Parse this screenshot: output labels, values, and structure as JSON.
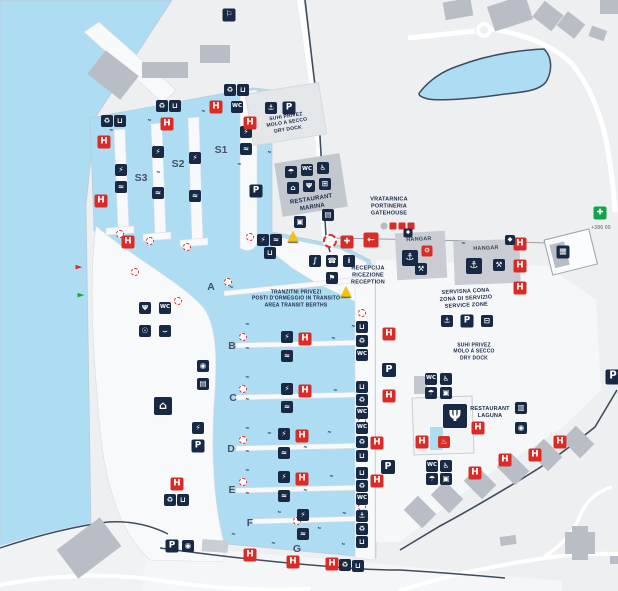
{
  "map_name": "marina-site-map",
  "colors": {
    "water": "#aedcf2",
    "land": "#edeff1",
    "pier": "#f7f9fb",
    "building": "#b9bec6",
    "navy": "#182945",
    "red": "#da2c26",
    "green": "#13a34a",
    "yellow": "#f3c403",
    "fence": "#3d4c5e",
    "text": "#1c2b4a"
  },
  "berths": [
    {
      "label": "S1",
      "x": 221,
      "y": 150
    },
    {
      "label": "S2",
      "x": 178,
      "y": 164
    },
    {
      "label": "S3",
      "x": 141,
      "y": 178
    },
    {
      "label": "A",
      "x": 211,
      "y": 287
    },
    {
      "label": "B",
      "x": 232,
      "y": 346
    },
    {
      "label": "C",
      "x": 233,
      "y": 398
    },
    {
      "label": "D",
      "x": 231,
      "y": 449
    },
    {
      "label": "E",
      "x": 232,
      "y": 490
    },
    {
      "label": "F",
      "x": 250,
      "y": 523
    },
    {
      "label": "G",
      "x": 297,
      "y": 549
    }
  ],
  "texts": [
    {
      "id": "drydock-top",
      "lines": [
        "SUHI PRIVEZ",
        "MOLO A SECCO",
        "DRY DOCK"
      ],
      "x": 287,
      "y": 123,
      "size": 5,
      "rot": -9
    },
    {
      "id": "restaurant-marina",
      "lines": [
        "RESTAURANT",
        "MARINA"
      ],
      "x": 312,
      "y": 204,
      "size": 6,
      "rot": -9
    },
    {
      "id": "gatehouse",
      "lines": [
        "VRATARNICA",
        "PORTINERIA",
        "GATEHOUSE"
      ],
      "x": 389,
      "y": 207,
      "size": 5.5,
      "rot": 0
    },
    {
      "id": "hangar-1",
      "lines": [
        "HANGAR"
      ],
      "x": 419,
      "y": 240,
      "size": 5.5,
      "rot": -3,
      "color": "#3e4857"
    },
    {
      "id": "hangar-2",
      "lines": [
        "HANGAR"
      ],
      "x": 486,
      "y": 249,
      "size": 5.5,
      "rot": -2,
      "color": "#3e4857"
    },
    {
      "id": "reception",
      "lines": [
        "RECEPCIJA",
        "RICEZIONE",
        "RECEPTION"
      ],
      "x": 368,
      "y": 276,
      "size": 5.5,
      "rot": 0
    },
    {
      "id": "transit-berths",
      "lines": [
        "TRANZITNI PRIVEZI",
        "POSTI D'ORMEGGIO IN TRANSITO",
        "AREA TRANSIT BERTHS"
      ],
      "x": 296,
      "y": 299,
      "size": 5,
      "rot": 0
    },
    {
      "id": "service-zone",
      "lines": [
        "SERVISNA CONA",
        "ZONA DI SERVIZIO",
        "SERVICE ZONE"
      ],
      "x": 466,
      "y": 299,
      "size": 5.5,
      "rot": -3
    },
    {
      "id": "drydock-right",
      "lines": [
        "SUHI PRIVEZ",
        "MOLO A SECCO",
        "DRY DOCK"
      ],
      "x": 474,
      "y": 352,
      "size": 5,
      "rot": 0
    },
    {
      "id": "restaurant-laguna",
      "lines": [
        "RESTAURANT",
        "LAGUNA"
      ],
      "x": 490,
      "y": 413,
      "size": 5.5,
      "rot": 0
    },
    {
      "id": "phone-number",
      "lines": [
        "+386 05"
      ],
      "x": 601,
      "y": 228,
      "size": 5,
      "rot": 0,
      "color": "#7f8992"
    }
  ],
  "marker_types": {
    "h": {
      "glyph": "H",
      "name": "hydrant-icon",
      "style": "red",
      "size": 13
    },
    "p": {
      "glyph": "P",
      "name": "parking-icon",
      "style": "navy",
      "size": 13
    },
    "plug": {
      "glyph": "⚡",
      "name": "electricity-icon",
      "style": "navy",
      "size": 12
    },
    "water": {
      "glyph": "≈",
      "name": "water-supply-icon",
      "style": "navy",
      "size": 12
    },
    "wc": {
      "glyph": "WC",
      "name": "wc-icon",
      "style": "navy",
      "size": 12
    },
    "acc": {
      "glyph": "♿",
      "name": "accessible-icon",
      "style": "navy",
      "size": 12
    },
    "shower": {
      "glyph": "☂",
      "name": "shower-icon",
      "style": "navy",
      "size": 12
    },
    "rest": {
      "glyph": "Ψ",
      "name": "restaurant-icon",
      "style": "navy",
      "size": 12
    },
    "bed": {
      "glyph": "⌂",
      "name": "hotel-icon",
      "style": "navy",
      "size": 12
    },
    "cart": {
      "glyph": "⊞",
      "name": "shop-cart-icon",
      "style": "navy",
      "size": 12
    },
    "rec": {
      "glyph": "♻",
      "name": "recycle-icon",
      "style": "navy",
      "size": 12
    },
    "trash": {
      "glyph": "⊔",
      "name": "trash-icon",
      "style": "navy",
      "size": 12
    },
    "phone": {
      "glyph": "☎",
      "name": "phone-icon",
      "style": "navy",
      "size": 12
    },
    "info": {
      "glyph": "i",
      "name": "info-icon",
      "style": "navy",
      "size": 12
    },
    "aid": {
      "glyph": "✚",
      "name": "first-aid-icon",
      "style": "red",
      "size": 13
    },
    "gcross": {
      "glyph": "✚",
      "name": "pharmacy-cross-icon",
      "style": "green",
      "size": 13
    },
    "ring": {
      "glyph": "",
      "name": "life-ring-icon",
      "style": "ring",
      "size": 14
    },
    "ringsm": {
      "glyph": "",
      "name": "life-ring-marker",
      "style": "ringsm",
      "size": 8
    },
    "fuel": {
      "glyph": "∫",
      "name": "fuel-station-icon",
      "style": "navy",
      "size": 12
    },
    "anchor": {
      "glyph": "⚓",
      "name": "boat-lift-icon",
      "style": "navy",
      "size": 12
    },
    "tools": {
      "glyph": "⚒",
      "name": "repair-icon",
      "style": "navy",
      "size": 12
    },
    "redtool": {
      "glyph": "⚙",
      "name": "travel-lift-icon",
      "style": "red",
      "size": 11
    },
    "flag": {
      "glyph": "⚐",
      "name": "windsock-icon",
      "style": "navy",
      "size": 13
    },
    "arrow": {
      "glyph": "←",
      "name": "entrance-arrow-icon",
      "style": "red",
      "size": 15
    },
    "navred": {
      "glyph": "►",
      "name": "port-light-red-icon",
      "style": "navr",
      "size": 9
    },
    "navgreen": {
      "glyph": "►",
      "name": "port-light-green-icon",
      "style": "navg",
      "size": 9
    },
    "warn": {
      "glyph": "▲",
      "name": "warning-icon",
      "style": "warn",
      "size": 14
    },
    "hash": {
      "glyph": "″",
      "name": "mooring-mark",
      "style": "hash",
      "size": 9
    },
    "cam": {
      "glyph": "◉",
      "name": "cctv-icon",
      "style": "navy",
      "size": 12
    },
    "vend": {
      "glyph": "▤",
      "name": "vending-icon",
      "style": "navy",
      "size": 12
    },
    "laundry": {
      "glyph": "▣",
      "name": "laundry-icon",
      "style": "navy",
      "size": 12
    },
    "shop": {
      "glyph": "▦",
      "name": "kiosk-icon",
      "style": "navy",
      "size": 13
    },
    "lockr": {
      "glyph": "▥",
      "name": "locker-icon",
      "style": "navy",
      "size": 12
    },
    "sign": {
      "glyph": "◆",
      "name": "sign-icon",
      "style": "navy",
      "size": 9
    },
    "grayd": {
      "glyph": "",
      "name": "gate-dot",
      "style": "gray",
      "size": 7
    },
    "redsq": {
      "glyph": "",
      "name": "gate-light",
      "style": "redsq",
      "size": 7
    },
    "spa": {
      "glyph": "♨",
      "name": "wellness-icon",
      "style": "red",
      "size": 12
    },
    "customs": {
      "glyph": "⚑",
      "name": "harbour-office-icon",
      "style": "navy",
      "size": 12
    },
    "trailer": {
      "glyph": "⊟",
      "name": "boat-trailer-icon",
      "style": "navy",
      "size": 12
    },
    "ball": {
      "glyph": "☉",
      "name": "sports-icon",
      "style": "navy",
      "size": 12
    },
    "hammock": {
      "glyph": "⌣",
      "name": "beach-icon",
      "style": "navy",
      "size": 12
    }
  },
  "markers": [
    [
      "navred",
      79,
      268
    ],
    [
      "navgreen",
      81,
      296
    ],
    [
      "ringsm",
      120,
      234
    ],
    [
      "ringsm",
      135,
      272
    ],
    [
      "ringsm",
      178,
      301
    ],
    [
      "ringsm",
      150,
      241
    ],
    [
      "ringsm",
      187,
      247
    ],
    [
      "ringsm",
      250,
      237
    ],
    [
      "ringsm",
      228,
      282
    ],
    [
      "ringsm",
      243,
      337
    ],
    [
      "ringsm",
      243,
      389
    ],
    [
      "ringsm",
      243,
      440
    ],
    [
      "ringsm",
      243,
      482
    ],
    [
      "ringsm",
      297,
      521
    ],
    [
      "ringsm",
      362,
      313
    ],
    [
      "ringsm",
      362,
      421
    ],
    [
      "ringsm",
      362,
      507
    ],
    [
      "hash",
      230,
      291
    ],
    [
      "hash",
      246,
      328
    ],
    [
      "hash",
      246,
      352
    ],
    [
      "hash",
      332,
      342
    ],
    [
      "hash",
      352,
      330
    ],
    [
      "hash",
      246,
      381
    ],
    [
      "hash",
      246,
      403
    ],
    [
      "hash",
      334,
      394
    ],
    [
      "hash",
      246,
      432
    ],
    [
      "hash",
      246,
      455
    ],
    [
      "hash",
      268,
      437
    ],
    [
      "hash",
      328,
      436
    ],
    [
      "hash",
      304,
      451
    ],
    [
      "hash",
      246,
      474
    ],
    [
      "hash",
      246,
      497
    ],
    [
      "hash",
      330,
      480
    ],
    [
      "hash",
      304,
      494
    ],
    [
      "hash",
      278,
      516
    ],
    [
      "hash",
      343,
      517
    ],
    [
      "hash",
      318,
      532
    ],
    [
      "hash",
      232,
      538
    ],
    [
      "hash",
      272,
      547
    ],
    [
      "hash",
      342,
      548
    ],
    [
      "hash",
      110,
      134
    ],
    [
      "hash",
      148,
      124
    ],
    [
      "hash",
      202,
      115
    ],
    [
      "hash",
      157,
      176
    ],
    [
      "hash",
      189,
      166
    ],
    [
      "hash",
      238,
      168
    ],
    [
      "hash",
      268,
      156
    ],
    [
      "hash",
      462,
      247
    ],
    [
      "rec",
      107,
      121
    ],
    [
      "trash",
      120,
      121
    ],
    [
      "rec",
      162,
      106
    ],
    [
      "trash",
      175,
      106
    ],
    [
      "rec",
      230,
      90
    ],
    [
      "trash",
      243,
      90
    ],
    [
      "wc",
      237,
      107
    ],
    [
      "plug",
      121,
      170
    ],
    [
      "water",
      121,
      187
    ],
    [
      "plug",
      158,
      152
    ],
    [
      "water",
      158,
      193
    ],
    [
      "plug",
      195,
      158
    ],
    [
      "water",
      195,
      196
    ],
    [
      "plug",
      246,
      132
    ],
    [
      "water",
      246,
      149
    ],
    [
      "plug",
      263,
      240
    ],
    [
      "water",
      276,
      240
    ],
    [
      "trash",
      270,
      253
    ],
    [
      "h",
      104,
      142
    ],
    [
      "h",
      167,
      124
    ],
    [
      "h",
      216,
      107
    ],
    [
      "h",
      250,
      123
    ],
    [
      "h",
      101,
      201
    ],
    [
      "h",
      128,
      242
    ],
    [
      "rest",
      145,
      308
    ],
    [
      "wc",
      165,
      308
    ],
    [
      "ball",
      145,
      331
    ],
    [
      "hammock",
      165,
      331
    ],
    [
      "cam",
      203,
      366
    ],
    [
      "vend",
      203,
      384
    ],
    [
      "bed",
      163,
      406,
      18
    ],
    [
      "plug",
      198,
      428
    ],
    [
      "p",
      198,
      446
    ],
    [
      "h",
      177,
      484
    ],
    [
      "rec",
      170,
      500
    ],
    [
      "trash",
      183,
      500
    ],
    [
      "p",
      172,
      546
    ],
    [
      "cam",
      188,
      546
    ],
    [
      "shower",
      291,
      172
    ],
    [
      "wc",
      307,
      170
    ],
    [
      "acc",
      323,
      168
    ],
    [
      "bed",
      293,
      188
    ],
    [
      "rest",
      309,
      186
    ],
    [
      "cart",
      325,
      184
    ],
    [
      "laundry",
      300,
      222
    ],
    [
      "vend",
      328,
      215
    ],
    [
      "p",
      256,
      191
    ],
    [
      "anchor",
      271,
      108
    ],
    [
      "p",
      289,
      108
    ],
    [
      "plug",
      287,
      337
    ],
    [
      "h",
      305,
      339
    ],
    [
      "water",
      287,
      356
    ],
    [
      "plug",
      287,
      389
    ],
    [
      "h",
      305,
      391
    ],
    [
      "water",
      287,
      407
    ],
    [
      "plug",
      284,
      434
    ],
    [
      "h",
      302,
      436
    ],
    [
      "water",
      284,
      453
    ],
    [
      "plug",
      284,
      477
    ],
    [
      "h",
      302,
      479
    ],
    [
      "water",
      284,
      496
    ],
    [
      "plug",
      303,
      515
    ],
    [
      "water",
      303,
      534
    ],
    [
      "trash",
      362,
      327
    ],
    [
      "rec",
      362,
      341
    ],
    [
      "wc",
      362,
      355
    ],
    [
      "h",
      389,
      334
    ],
    [
      "p",
      389,
      370,
      14
    ],
    [
      "trash",
      362,
      387
    ],
    [
      "rec",
      362,
      400
    ],
    [
      "wc",
      362,
      413
    ],
    [
      "h",
      389,
      396
    ],
    [
      "wc",
      362,
      428
    ],
    [
      "rec",
      362,
      442
    ],
    [
      "trash",
      362,
      456
    ],
    [
      "h",
      377,
      443
    ],
    [
      "p",
      388,
      467,
      14
    ],
    [
      "trash",
      362,
      473
    ],
    [
      "rec",
      362,
      486
    ],
    [
      "wc",
      362,
      499
    ],
    [
      "h",
      377,
      481
    ],
    [
      "anchor",
      362,
      516
    ],
    [
      "rec",
      362,
      529
    ],
    [
      "trash",
      362,
      542
    ],
    [
      "h",
      250,
      555
    ],
    [
      "h",
      293,
      562
    ],
    [
      "h",
      332,
      564
    ],
    [
      "rec",
      345,
      565
    ],
    [
      "trash",
      358,
      566
    ],
    [
      "h",
      520,
      244
    ],
    [
      "h",
      520,
      266
    ],
    [
      "h",
      520,
      288
    ],
    [
      "p",
      613,
      377,
      15
    ],
    [
      "ring",
      330,
      241
    ],
    [
      "aid",
      347,
      242
    ],
    [
      "fuel",
      315,
      261
    ],
    [
      "phone",
      332,
      261
    ],
    [
      "info",
      349,
      261
    ],
    [
      "customs",
      332,
      278
    ],
    [
      "grayd",
      384,
      226
    ],
    [
      "redsq",
      393,
      226
    ],
    [
      "redsq",
      402,
      226
    ],
    [
      "redsq",
      411,
      226
    ],
    [
      "arrow",
      371,
      240
    ],
    [
      "sign",
      408,
      233
    ],
    [
      "sign",
      510,
      240,
      10
    ],
    [
      "anchor",
      410,
      258,
      16
    ],
    [
      "redtool",
      427,
      251
    ],
    [
      "tools",
      421,
      269
    ],
    [
      "anchor",
      474,
      266,
      16
    ],
    [
      "tools",
      499,
      265
    ],
    [
      "anchor",
      447,
      321
    ],
    [
      "p",
      467,
      321
    ],
    [
      "trailer",
      487,
      321
    ],
    [
      "wc",
      431,
      379
    ],
    [
      "acc",
      446,
      379
    ],
    [
      "shower",
      431,
      393
    ],
    [
      "laundry",
      446,
      393
    ],
    [
      "wc",
      432,
      466
    ],
    [
      "acc",
      446,
      466
    ],
    [
      "shower",
      432,
      479
    ],
    [
      "laundry",
      446,
      479
    ],
    [
      "rest",
      455,
      416,
      24
    ],
    [
      "h",
      478,
      428
    ],
    [
      "h",
      422,
      442
    ],
    [
      "spa",
      444,
      442
    ],
    [
      "lockr",
      521,
      408
    ],
    [
      "cam",
      521,
      428
    ],
    [
      "h",
      475,
      473
    ],
    [
      "h",
      505,
      460
    ],
    [
      "h",
      535,
      455
    ],
    [
      "h",
      560,
      442
    ],
    [
      "gcross",
      600,
      213
    ],
    [
      "flag",
      229,
      15
    ],
    [
      "shop",
      563,
      252
    ],
    [
      "warn",
      293,
      236
    ],
    [
      "warn",
      346,
      291
    ]
  ]
}
